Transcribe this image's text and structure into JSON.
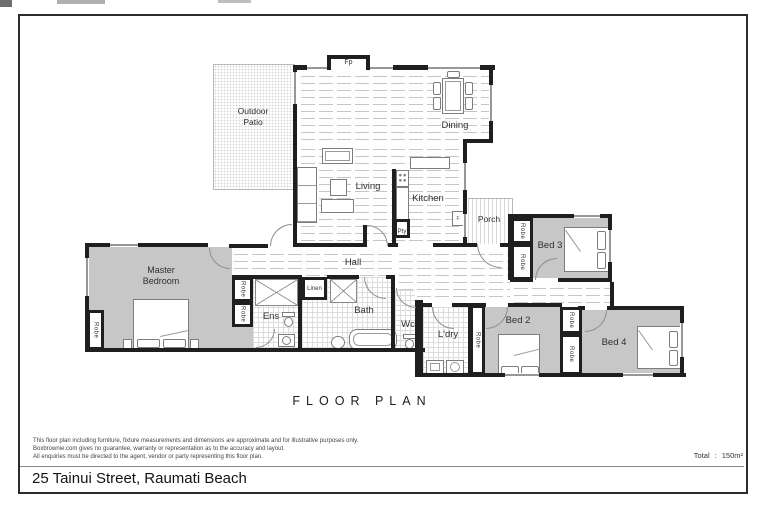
{
  "page": {
    "title": "FLOOR PLAN",
    "address": "25 Tainui Street, Raumati Beach",
    "total_label": "Total",
    "total_colon": ":",
    "total_value": "150m²",
    "disclaimer": [
      "This floor plan including furniture, fixture measurements and dimensions are approximate and for illustrative purposes only.",
      "Boxbrownie.com gives no guarantee, warranty or representation as to the accuracy and layout.",
      "All enquiries must be directed to the agent, vendor or party representing this floor plan."
    ]
  },
  "rooms": {
    "outdoor_patio": "Outdoor Patio",
    "dining": "Dining",
    "living": "Living",
    "kitchen": "Kitchen",
    "pantry": "Pty",
    "fireplace": "Fp",
    "fridge": "F",
    "porch": "Porch",
    "hall": "Hall",
    "master_bedroom": "Master Bedroom",
    "ensuite": "Ens",
    "linen": "Linen",
    "bath": "Bath",
    "wc": "Wc",
    "laundry": "L'dry",
    "bed2": "Bed 2",
    "bed3": "Bed 3",
    "bed4": "Bed 4",
    "robe": "Robe"
  },
  "colors": {
    "wall": "#1f1f1f",
    "carpet": "#c7c7c7",
    "floor_line": "#c6c6c6",
    "tile_line": "#dcdcdc",
    "frame": "#2b2b2b",
    "label": "#2f2f2f"
  }
}
